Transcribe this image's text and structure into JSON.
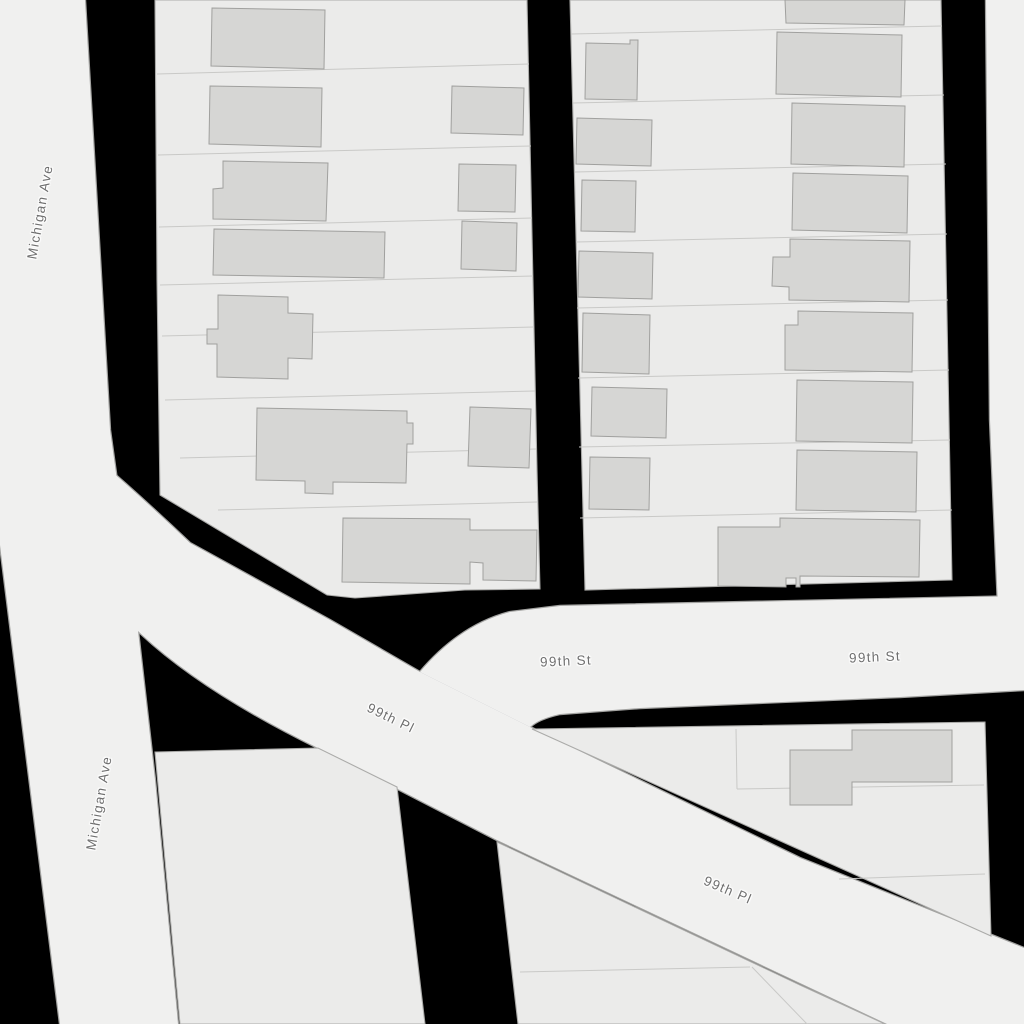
{
  "map": {
    "type": "street-map",
    "colors": {
      "bg": "#000000",
      "road-fill": "#f0f0ef",
      "road-casing": "#a2a2a0",
      "parcel-fill": "#ebebea",
      "block-stroke": "#ababa9",
      "parcel-line": "#c9c9c7",
      "building-fill": "#d6d6d4",
      "building-stroke": "#a0a09e",
      "label-color": "#6f6f6f"
    },
    "streets": {
      "michigan_ave": "Michigan Ave",
      "ninety_ninth_st": "99th St",
      "ninety_ninth_pl": "99th Pl"
    },
    "labels": [
      {
        "id": "michigan-ave-1",
        "text": "Michigan Ave"
      },
      {
        "id": "michigan-ave-2",
        "text": "Michigan Ave"
      },
      {
        "id": "99th-st-1",
        "text": "99th St"
      },
      {
        "id": "99th-st-2",
        "text": "99th St"
      },
      {
        "id": "99th-pl-1",
        "text": "99th Pl"
      },
      {
        "id": "99th-pl-2",
        "text": "99th Pl"
      }
    ]
  }
}
